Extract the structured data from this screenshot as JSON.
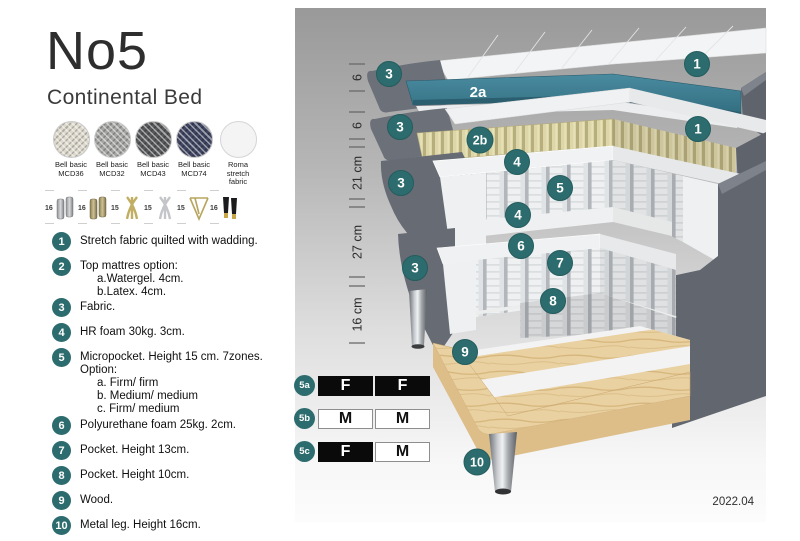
{
  "header": {
    "title": "No5",
    "subtitle": "Continental Bed"
  },
  "swatches": [
    {
      "line1": "Bell basic",
      "line2": "MCD36"
    },
    {
      "line1": "Bell basic",
      "line2": "MCD32"
    },
    {
      "line1": "Bell basic",
      "line2": "MCD43"
    },
    {
      "line1": "Bell basic",
      "line2": "MCD74"
    },
    {
      "line1": "Roma",
      "line2": "stretch fabric"
    }
  ],
  "legs": [
    {
      "height": "16",
      "style": "cylinder-silver"
    },
    {
      "height": "16",
      "style": "cylinder-brass"
    },
    {
      "height": "15",
      "style": "cross-gold"
    },
    {
      "height": "15",
      "style": "cross-silver"
    },
    {
      "height": "15",
      "style": "hairpin-gold"
    },
    {
      "height": "16",
      "style": "cylinder-black-gold"
    }
  ],
  "list": {
    "items": [
      {
        "num": "1",
        "lines": [
          "Stretch fabric quilted with wadding."
        ]
      },
      {
        "num": "2",
        "lines": [
          "Top mattres option:",
          "a.Watergel. 4cm.",
          "b.Latex. 4cm."
        ]
      },
      {
        "num": "3",
        "lines": [
          "Fabric."
        ]
      },
      {
        "num": "4",
        "lines": [
          "HR foam 30kg. 3cm."
        ]
      },
      {
        "num": "5",
        "lines": [
          "Micropocket. Height 15 cm. 7zones. Option:",
          "a. Firm/ firm",
          "b. Medium/ medium",
          "c. Firm/ medium"
        ]
      },
      {
        "num": "6",
        "lines": [
          "Polyurethane foam 25kg. 2cm."
        ]
      },
      {
        "num": "7",
        "lines": [
          "Pocket. Height 13cm."
        ]
      },
      {
        "num": "8",
        "lines": [
          "Pocket. Height 10cm."
        ]
      },
      {
        "num": "9",
        "lines": [
          "Wood."
        ]
      },
      {
        "num": "10",
        "lines": [
          "Metal leg. Height 16cm."
        ]
      }
    ]
  },
  "diagram": {
    "ruler": [
      "6",
      "6",
      "21 cm",
      "27 cm",
      "16 cm"
    ],
    "callouts": {
      "c1a": "1",
      "c3a": "3",
      "c2a": "2a",
      "c3b": "3",
      "c2b": "2b",
      "c1b": "1",
      "c4a": "4",
      "c5": "5",
      "c3c": "3",
      "c4b": "4",
      "c6": "6",
      "c7": "7",
      "c3d": "3",
      "c8": "8",
      "c9": "9",
      "c10": "10"
    },
    "version": "2022.04"
  },
  "firmness": {
    "rows": [
      {
        "id": "5a",
        "cells": [
          {
            "letter": "F"
          },
          {
            "letter": "F"
          }
        ]
      },
      {
        "id": "5b",
        "cells": [
          {
            "letter": "M"
          },
          {
            "letter": "M"
          }
        ]
      },
      {
        "id": "5c",
        "cells": [
          {
            "letter": "F"
          },
          {
            "letter": "M"
          }
        ]
      }
    ]
  },
  "colors": {
    "accent_teal": "#2d6c6e",
    "topper_core": "#3e7e90",
    "fabric_gray": "#6a6f77",
    "latex": "#dcd5a7",
    "wood": "#e8d0a0",
    "diagram_bg_top": "#9a9a9a"
  }
}
